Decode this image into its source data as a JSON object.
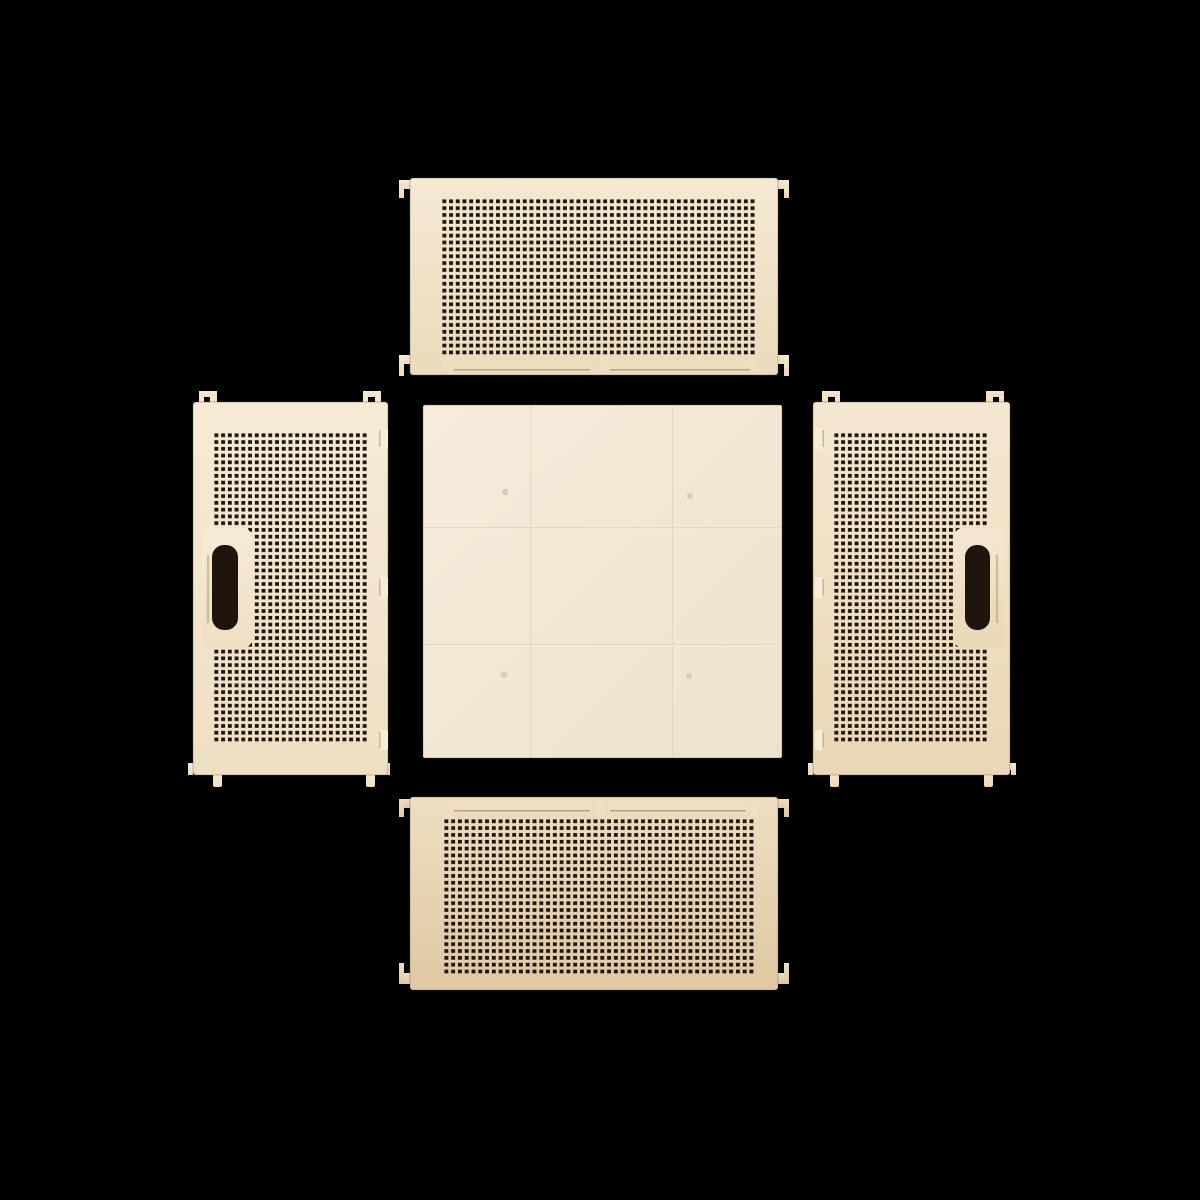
{
  "scene": {
    "type": "product-photo",
    "subject": "Five flat panels of a disassembled collapsible plastic storage crate arranged in a cross on a black background",
    "panel_count": 5
  },
  "colors": {
    "background": "#000000",
    "top_light": "#f6e9d3",
    "top_dark": "#eadbbc",
    "bottom_light": "#eedec2",
    "bottom_dark": "#dfc8a3",
    "left_light": "#f7ebd7",
    "left_dark": "#eedfc4",
    "right_light": "#f5e7d1",
    "right_dark": "#e9d7b6",
    "base_light": "#f6ecdc",
    "base_dark": "#efe2cd",
    "hole": "#1f150d",
    "hole_lip": "rgba(255,255,255,0.45)",
    "bar": "#eedfc3",
    "bar_shadow": "#a98f66",
    "clip": "#f6ecd9",
    "clip_shadow": "#b59c73",
    "seam": "#e3d5c0",
    "seam_hi": "#fbf3e6",
    "dimple": "#ddcdb4",
    "rim": "rgba(110,85,50,0.38)"
  },
  "panels": {
    "top_side": {
      "label": "top side panel, perforated mesh",
      "hole_grid": "47 x 23 square holes",
      "hinge_bars": 2,
      "corner_hooks": 4
    },
    "left_side": {
      "label": "left side panel, perforated mesh",
      "hole_grid": "23 x 46 square holes",
      "handle": "vertical slot near left edge",
      "edge_clips": 3,
      "corner_hooks": 4
    },
    "base": {
      "label": "solid base panel",
      "seams": "faint 3 x 3 grid lines",
      "dimples": 4
    },
    "right_side": {
      "label": "right side panel, perforated mesh",
      "hole_grid": "23 x 46 square holes",
      "handle": "vertical slot near right edge",
      "edge_clips": 3,
      "corner_hooks": 4
    },
    "bottom_side": {
      "label": "bottom side panel, perforated mesh",
      "hole_grid": "46 x 23 square holes",
      "hinge_bars": 2,
      "corner_hooks": 4
    }
  }
}
